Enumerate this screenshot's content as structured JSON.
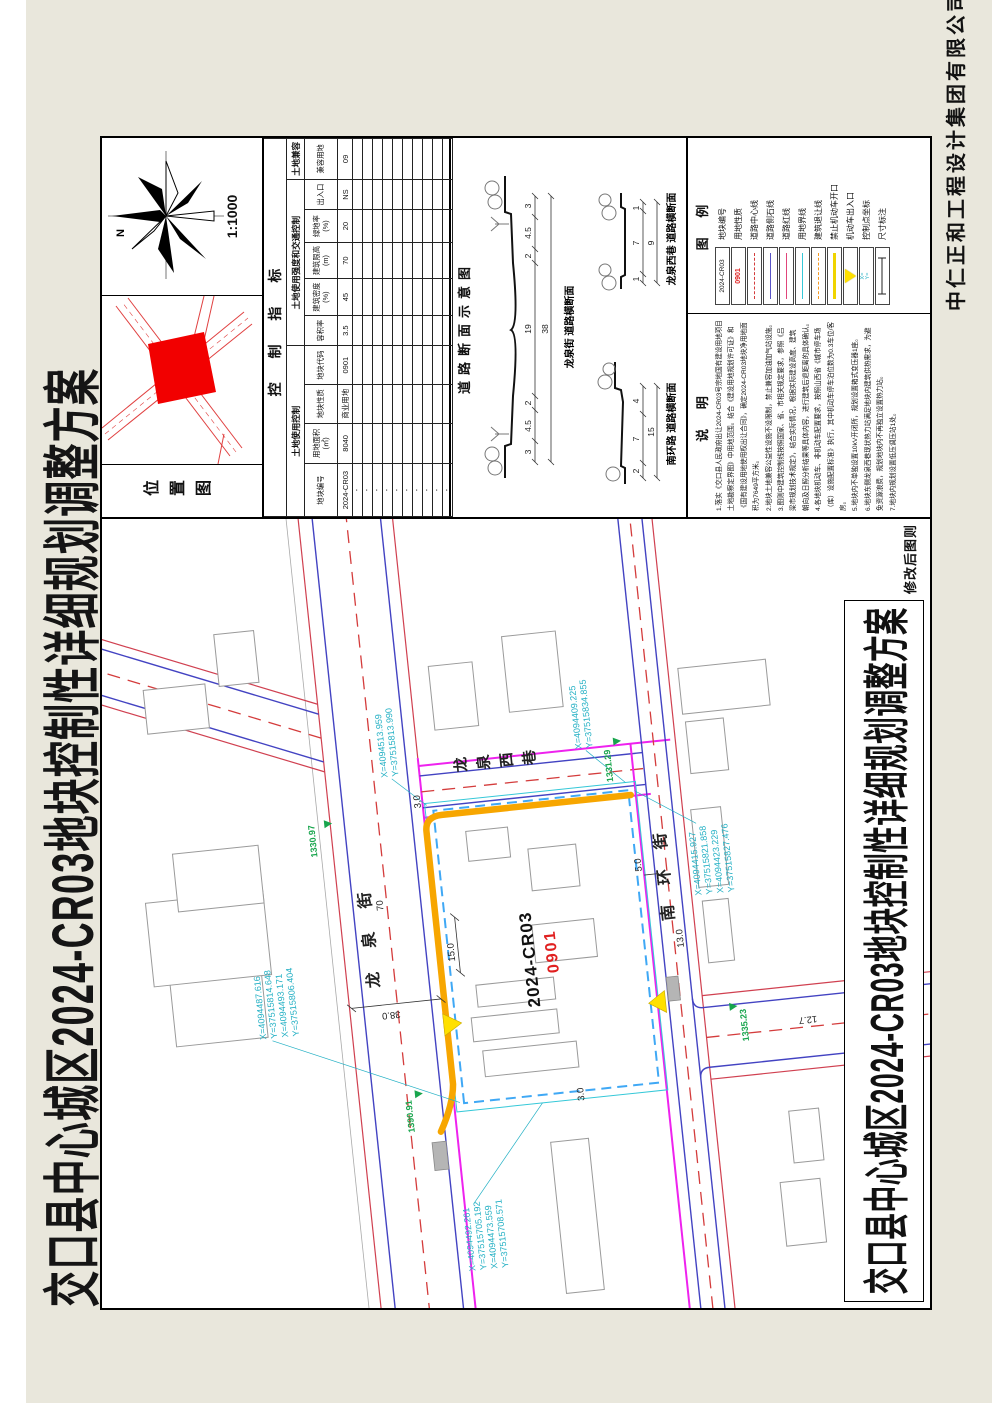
{
  "sheet": {
    "top_title": "交口县中心城区2024-CR03地块控制性详细规划调整方案",
    "bottom_title": "交口县中心城区2024-CR03地块控制性详细规划调整方案",
    "company": "中仁正和工程设计集团有限公司",
    "revision_note": "修改后图则"
  },
  "location_panel": {
    "label": "位置图",
    "north": "N",
    "scale": "1:1000"
  },
  "control_table": {
    "title": "控 制 指 标",
    "groups": [
      "土地使用控制",
      "土地使用强度和交通控制",
      "土地兼容"
    ],
    "columns": [
      "地块编号",
      "用地面积\n(㎡)",
      "地块性质",
      "地块代码",
      "容积率",
      "建筑密度\n(%)",
      "建筑限高\n(m)",
      "绿地率\n(%)",
      "出入口",
      "兼容用地"
    ],
    "row": [
      "2024-CR03",
      "8040",
      "商业用地",
      "0901",
      "3.5",
      "45",
      "70",
      "20",
      "NS",
      "09"
    ],
    "dash": "-"
  },
  "road_sections": {
    "title": "道路断面示意图",
    "sections": [
      {
        "name": "龙泉街 道路横断面",
        "segments": [
          "3",
          "4.5",
          "2",
          "19",
          "2",
          "4.5",
          "3"
        ],
        "total": "38"
      },
      {
        "name": "南环路 道路横断面",
        "segments": [
          "2",
          "7",
          "4"
        ],
        "total": "15"
      },
      {
        "name": "龙泉西巷 道路横断面",
        "segments": [
          "1",
          "7",
          "1"
        ],
        "total": "9"
      }
    ]
  },
  "notes": {
    "title": "说 明",
    "lines": [
      "1.落实《交口县人民政府出让2024-CR03号宗地国有建设用地项目",
      "土地勘察定界图》中用地范围。结合《建设用地规划许可证》和",
      "《国有建设用地使用权出让合同》，确定2024-CR03地块净用地面",
      "积为7649平方米。",
      "2.地块土地兼容公益性设施不设限制，禁止兼容加油加气站设施。",
      "3.图则中建筑控制线按照国家、省、市相关规定要求，参照《吕",
      "梁市规划技术规定》，结合实际情况，根据实际建设高度、建筑",
      "朝向及日照分析结果等具体内容，进行建筑后退距离的具体确认。",
      "4.各地块机动车、非机动车配置要求，按照山西省《城市停车场",
      "（库）设施配置标准》执行，其中机动车停车泊位数为0.3车位/客",
      "房。",
      "5.地块内不单独设置10kV开闭所，规划设置箱式变压器1座。",
      "6.地块东侧龙泉西巷现状热力站满足地块内建筑供热需求，为避",
      "免资源浪费，规划地块内不再独立设置热力站。",
      "7.地块内规划设置低压调压站1处。"
    ]
  },
  "legend": {
    "title": "图 例",
    "items": [
      {
        "label": "地块编号",
        "symbol_text": "2024-CR03"
      },
      {
        "label": "用地性质",
        "symbol_text": "0901"
      },
      {
        "label": "道路中心线",
        "color": "#d43c3c"
      },
      {
        "label": "道路侧石线",
        "color": "#5a55c8"
      },
      {
        "label": "道路红线",
        "color": "#e0457b"
      },
      {
        "label": "用地界线",
        "color": "#35c8d8"
      },
      {
        "label": "建筑退让线",
        "color": "#f59a23"
      },
      {
        "label": "禁止机动车开口",
        "color": "#f0d400"
      },
      {
        "label": "机动车出入口",
        "color": "#ffe000"
      },
      {
        "label": "控制点坐标",
        "symbol_text": "X=\nY="
      },
      {
        "label": "尺寸标注"
      }
    ]
  },
  "map": {
    "parcel_code": "2024-CR03",
    "parcel_use": "0901",
    "streets": {
      "north": "龙泉街",
      "east": "龙泉西巷",
      "south": "南环街"
    },
    "coords": [
      {
        "x": "X=4094513.959",
        "y": "Y=37515813.990"
      },
      {
        "x": "X=4094409.225",
        "y": "Y=37515834.855"
      },
      {
        "x": "X=4094415.927",
        "y": "Y=37515821.858"
      },
      {
        "x": "X=4094423.229",
        "y": "Y=37515827.476"
      },
      {
        "x": "X=4094487.616",
        "y": "Y=37515814.648"
      },
      {
        "x": "X=4094493.171",
        "y": "Y=37515806.404"
      },
      {
        "x": "X=4094492.261",
        "y": "Y=37515705.192"
      },
      {
        "x": "X=4094473.559",
        "y": "Y=37515708.571"
      }
    ],
    "green_marks": [
      "1330.97",
      "1390.91",
      "1331.29",
      "1335.23"
    ],
    "dimensions": [
      "38.0",
      "70",
      "15.0",
      "3.0",
      "3.0",
      "5.0",
      "13.0",
      "12.7"
    ]
  },
  "colors": {
    "road_centerline": "#d43c3c",
    "curb": "#5a55c8",
    "road_redline": "#e0457b",
    "parcel_boundary_cyan": "#35c8d8",
    "setback": "#f59a23",
    "no_opening": "#f7a600",
    "entrance_arrow": "#ffe000",
    "coord_text": "#23b0c4",
    "green_mark": "#18a54d",
    "parcel_fill_locmap": "#f20000",
    "sheet_margin": "#e9e7dc"
  }
}
